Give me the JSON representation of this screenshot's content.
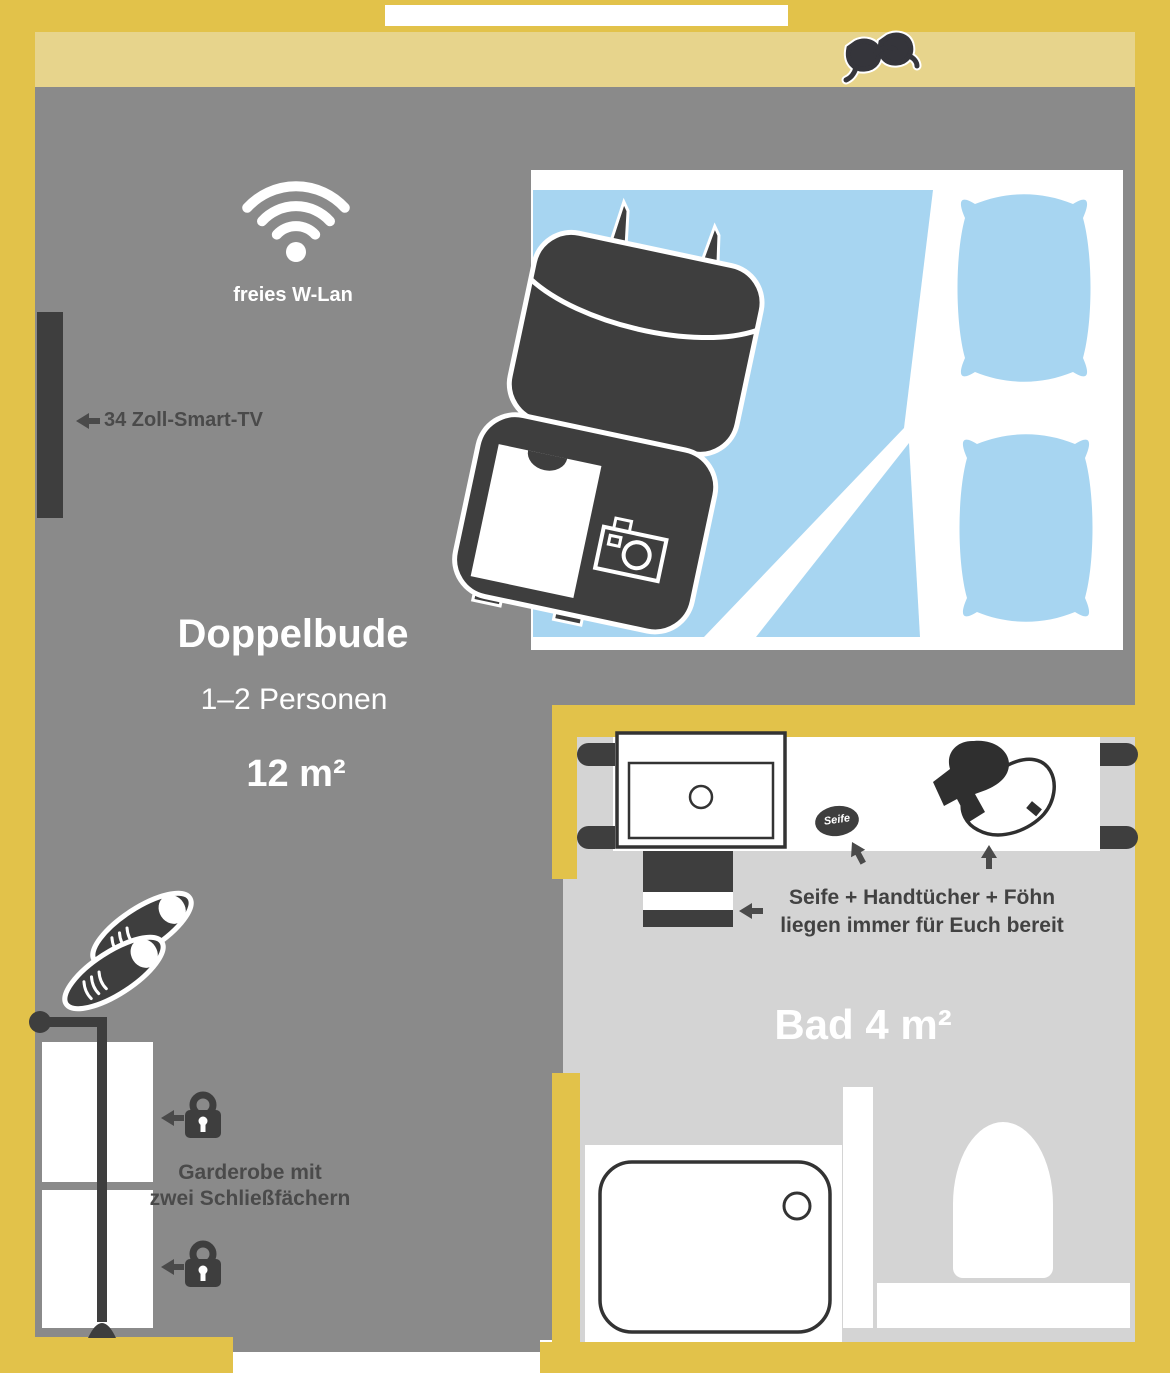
{
  "colors": {
    "wall": "#E2C24A",
    "sill": "#E7D48C",
    "room": "#8A8A8A",
    "bath": "#D4D4D4",
    "dark": "#3E3E3E",
    "txt": "#4A4A4A",
    "blue": "#A7D5F1"
  },
  "room": {
    "name": "Doppelbude",
    "capacity": "1–2 Personen",
    "area": "12 m²",
    "wifi_label": "freies W-Lan",
    "tv_label": "34 Zoll-Smart-TV",
    "wardrobe_line1": "Garderobe mit",
    "wardrobe_line2": "zwei Schließfächern"
  },
  "bathroom": {
    "name": "Bad 4 m²",
    "soap_label": "Seife",
    "amenities_line1": "Seife + Handtücher + Föhn",
    "amenities_line2": "liegen immer für Euch bereit"
  },
  "icons": {
    "wifi": "wifi-icon",
    "tv": "smart-tv",
    "sunglasses": "sunglasses-icon",
    "suitcase": "open-suitcase-icon",
    "tshirt": "tshirt-icon",
    "camera": "camera-icon",
    "pillow": "pillow-icon",
    "bedsheet": "bedsheet-icon",
    "shoes": "shoes-icon",
    "coat_rack": "coat-rack-icon",
    "padlock": "padlock-icon",
    "sink": "washbasin-icon",
    "towels": "towel-stack-icon",
    "soap": "soap-icon",
    "hairdryer": "hairdryer-icon",
    "shower": "shower-tray-icon",
    "toilet": "toilet-icon",
    "arrow": "arrow-icon"
  }
}
